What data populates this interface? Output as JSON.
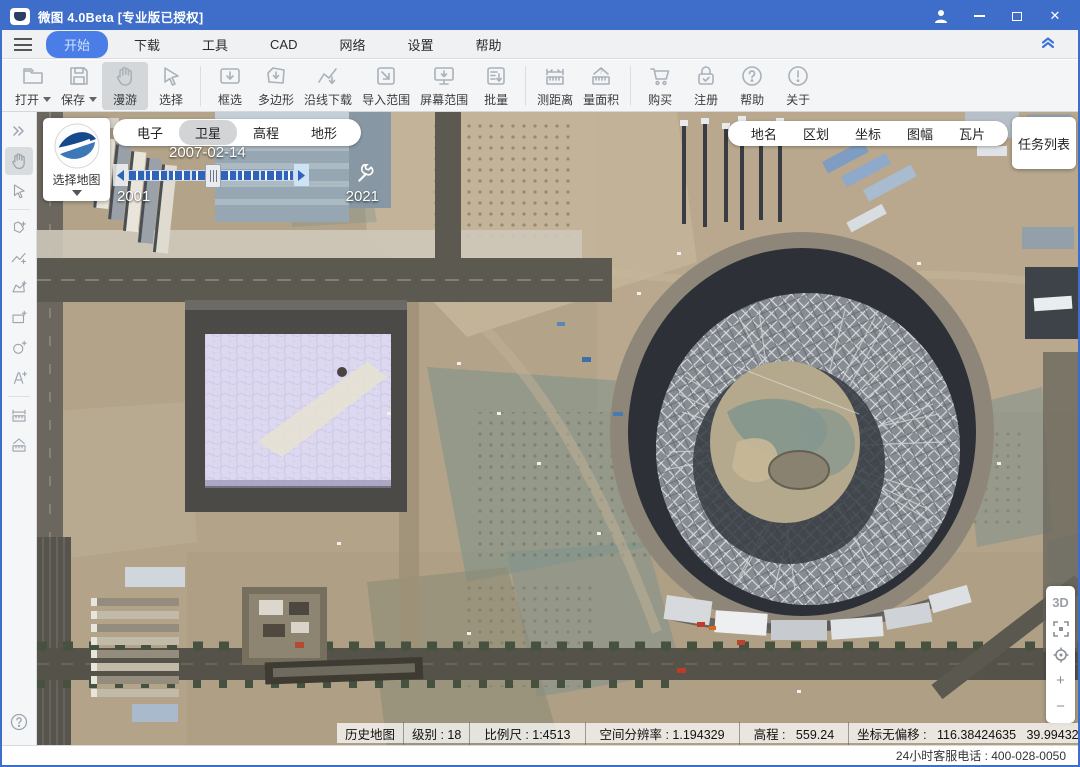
{
  "window": {
    "title": "微图 4.0Beta [专业版已授权]"
  },
  "colors": {
    "titlebar": "#3e6eca",
    "menu_active": "#4a7de6",
    "slider_blue": "#2f64b8",
    "water_cube": "#dcd8f0"
  },
  "menu": {
    "items": [
      {
        "label": "开始",
        "active": true
      },
      {
        "label": "下载"
      },
      {
        "label": "工具"
      },
      {
        "label": "CAD"
      },
      {
        "label": "网络"
      },
      {
        "label": "设置"
      },
      {
        "label": "帮助"
      }
    ]
  },
  "toolbar": {
    "items": [
      {
        "label": "打开",
        "dropdown": true
      },
      {
        "label": "保存",
        "dropdown": true
      },
      {
        "label": "漫游",
        "active": true
      },
      {
        "label": "选择"
      },
      {
        "label": "框选"
      },
      {
        "label": "多边形"
      },
      {
        "label": "沿线下载"
      },
      {
        "label": "导入范围"
      },
      {
        "label": "屏幕范围"
      },
      {
        "label": "批量"
      },
      {
        "label": "测距离"
      },
      {
        "label": "量面积"
      },
      {
        "label": "购买"
      },
      {
        "label": "注册"
      },
      {
        "label": "帮助"
      },
      {
        "label": "关于"
      }
    ]
  },
  "map_overlay": {
    "map_picker_label": "选择地图",
    "layer_tabs": [
      {
        "label": "电子"
      },
      {
        "label": "卫星",
        "active": true
      },
      {
        "label": "高程"
      },
      {
        "label": "地形"
      }
    ],
    "timeline": {
      "current_date": "2007-02-14",
      "start_year": "2001",
      "end_year": "2021"
    },
    "info_tabs": [
      {
        "label": "地名"
      },
      {
        "label": "区划"
      },
      {
        "label": "坐标"
      },
      {
        "label": "图幅"
      },
      {
        "label": "瓦片"
      }
    ],
    "task_list_label": "任务列表",
    "zoom_controls": {
      "three_d": "3D",
      "zoom_in": "+",
      "zoom_out": "−"
    }
  },
  "status_bar": {
    "history": "历史地图",
    "level": "级别 : 18",
    "scale": "比例尺 : 1:4513",
    "resolution": "空间分辨率 : 1.194329",
    "elevation": "高程 :   559.24",
    "coords": "坐标无偏移 :   116.38424635   39.9943220"
  },
  "footer": {
    "service_phone": "24小时客服电话 : 400-028-0050"
  }
}
